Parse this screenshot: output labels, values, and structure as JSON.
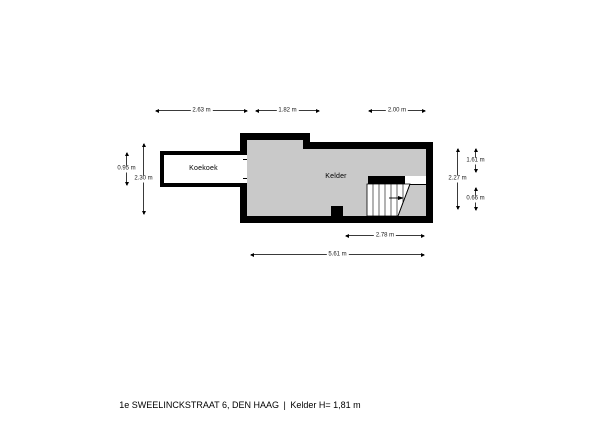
{
  "plan": {
    "rooms": {
      "koekoek": "Koekoek",
      "kelder": "Kelder"
    }
  },
  "dimensions": {
    "top_left": "2.63 m",
    "top_middle": "1.82 m",
    "top_right": "2.00 m",
    "left_outer": "0.95 m",
    "left_inner": "2.30 m",
    "right_inner": "2.27 m",
    "right_outer_top": "1.61 m",
    "right_outer_bottom": "0.66 m",
    "bottom_inner": "2.78 m",
    "bottom_outer": "5.61 m"
  },
  "footer": {
    "address": "1e SWEELINCKSTRAAT 6, DEN HAAG",
    "separator": "|",
    "level_info": "Kelder H= 1,81 m"
  },
  "colors": {
    "wall": "#000000",
    "floor": "#c9c9c9",
    "background": "#ffffff"
  }
}
